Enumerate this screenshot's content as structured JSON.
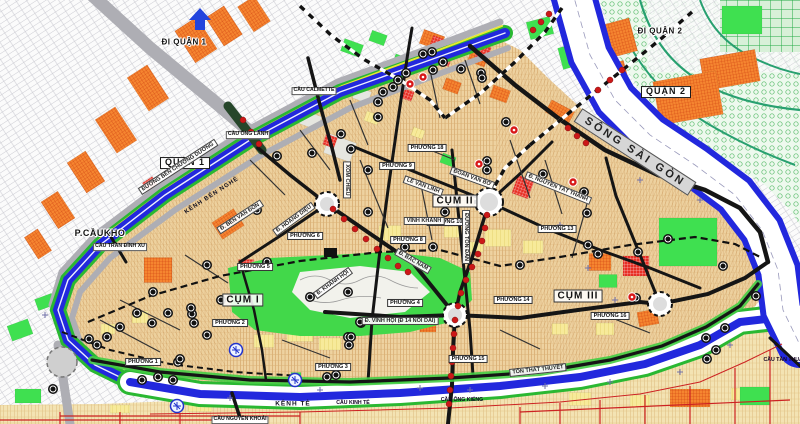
{
  "palette": {
    "river_blue": "#2228dd",
    "canal_green_bank": "#2ab832",
    "land_tan": "#eed2a0",
    "park_green": "#42d84a",
    "parcel_orange": "#f58530",
    "parcel_red": "#e82f25",
    "parcel_yellow": "#f7ea9a",
    "road_black": "#151515",
    "road_grey": "#aeaeb4",
    "d7_road_red": "#cc2222",
    "q2_road_teal": "#28a070",
    "station_dot_red": "#cc1818",
    "label_band_grey": "#d6d6d6"
  },
  "labels": {
    "regions": [
      {
        "id": "di-quan-1",
        "text": "ĐI QUẬN 1",
        "x": 184,
        "y": 43,
        "rot": 0,
        "style": "plain-bold halo",
        "size": 8
      },
      {
        "id": "di-quan-2",
        "text": "ĐI QUẬN 2",
        "x": 660,
        "y": 32,
        "rot": 0,
        "style": "plain-bold halo",
        "size": 8
      },
      {
        "id": "quan-1",
        "text": "QUẬN 1",
        "x": 185,
        "y": 163,
        "rot": 0,
        "style": "boxed-lg",
        "size": 9
      },
      {
        "id": "quan-2",
        "text": "QUẬN 2",
        "x": 666,
        "y": 92,
        "rot": 0,
        "style": "boxed-lg",
        "size": 9
      },
      {
        "id": "p-caukho",
        "text": "P.CẦUKHO",
        "x": 100,
        "y": 234,
        "rot": 0,
        "style": "plain-bold halo",
        "size": 9
      },
      {
        "id": "cum-1",
        "text": "CỤM I",
        "x": 243,
        "y": 300,
        "rot": 0,
        "style": "cum",
        "size": 10
      },
      {
        "id": "cum-2",
        "text": "CỤM II",
        "x": 455,
        "y": 201,
        "rot": 0,
        "style": "cum",
        "size": 10
      },
      {
        "id": "cum-3",
        "text": "CỤM III",
        "x": 578,
        "y": 296,
        "rot": 0,
        "style": "cum",
        "size": 10
      }
    ],
    "water": [
      {
        "id": "song-sai-gon",
        "text": "SÔNG SÀI GÒN",
        "x": 635,
        "y": 152,
        "rot": 33,
        "style": "river-band",
        "size": 11
      },
      {
        "id": "kenh-ben-nghe",
        "text": "KÊNH BẾN NGHÉ",
        "x": 212,
        "y": 196,
        "rot": -33,
        "style": "canal-lbl",
        "size": 6
      },
      {
        "id": "kenh-te",
        "text": "KÊNH TẺ",
        "x": 293,
        "y": 404,
        "rot": 0,
        "style": "canal-lbl",
        "size": 6.5
      }
    ],
    "wards": [
      {
        "text": "PHƯỜNG 1",
        "x": 143,
        "y": 362
      },
      {
        "text": "PHƯỜNG 2",
        "x": 230,
        "y": 323
      },
      {
        "text": "PHƯỜNG 3",
        "x": 333,
        "y": 367
      },
      {
        "text": "PHƯỜNG 4",
        "x": 405,
        "y": 303
      },
      {
        "text": "PHƯỜNG 5",
        "x": 255,
        "y": 267
      },
      {
        "text": "PHƯỜNG 6",
        "x": 305,
        "y": 236
      },
      {
        "text": "PHƯỜNG 8",
        "x": 408,
        "y": 240
      },
      {
        "text": "PHƯỜNG 9",
        "x": 397,
        "y": 166
      },
      {
        "text": "PHƯỜNG 10",
        "x": 446,
        "y": 222
      },
      {
        "text": "PHƯỜNG 13",
        "x": 557,
        "y": 229
      },
      {
        "text": "PHƯỜNG 14",
        "x": 513,
        "y": 300
      },
      {
        "text": "PHƯỜNG 15",
        "x": 468,
        "y": 359
      },
      {
        "text": "PHƯỜNG 16",
        "x": 610,
        "y": 316
      },
      {
        "text": "PHƯỜNG 18",
        "x": 427,
        "y": 148
      }
    ],
    "streets": [
      {
        "text": "ĐƯỜNG BẾN CHƯƠNG DƯƠNG",
        "x": 178,
        "y": 167,
        "rot": -33
      },
      {
        "text": "Đ. BẾN VÂN ĐỒN",
        "x": 240,
        "y": 217,
        "rot": -33
      },
      {
        "text": "Đ. NGUYỄN TẤT THÀNH",
        "x": 558,
        "y": 188,
        "rot": 22
      },
      {
        "text": "LÊ VĂN LINH",
        "x": 423,
        "y": 186,
        "rot": 20
      },
      {
        "text": "ĐOÀN VĂN BƠ",
        "x": 472,
        "y": 178,
        "rot": 20
      },
      {
        "text": "ĐƯỜNG TÔN ĐẢN",
        "x": 466,
        "y": 237,
        "rot": 90
      },
      {
        "text": "XÓM CHIẾU",
        "x": 347,
        "y": 180,
        "rot": 90
      },
      {
        "text": "Đ. HOÀNG DIỆU",
        "x": 294,
        "y": 219,
        "rot": -36
      },
      {
        "text": "Đ. BẮC NAM",
        "x": 413,
        "y": 261,
        "rot": 30
      },
      {
        "text": "Đ. VĨNH HỘI (Đ 14 NỐI DÀI)",
        "x": 400,
        "y": 321,
        "rot": 0
      },
      {
        "text": "VĨNH KHÁNH",
        "x": 424,
        "y": 221,
        "rot": 0
      },
      {
        "text": "Đ. KHÁNH HỘI",
        "x": 333,
        "y": 283,
        "rot": -36
      },
      {
        "text": "TÔN THẤT THUYẾT",
        "x": 538,
        "y": 370,
        "rot": -6
      }
    ],
    "bridges": [
      {
        "text": "CẦU ÔNG LÃNH",
        "x": 248,
        "y": 135,
        "boxed": true
      },
      {
        "text": "CẦU CALMETTE",
        "x": 314,
        "y": 91,
        "boxed": true
      },
      {
        "text": "CẦU TRẦN ĐÌNH XU",
        "x": 120,
        "y": 247,
        "boxed": true
      },
      {
        "text": "CẦU NGUYỄN KHOÁI",
        "x": 240,
        "y": 420,
        "boxed": true
      },
      {
        "text": "CẦU KINH TẺ",
        "x": 353,
        "y": 404,
        "boxed": false
      },
      {
        "text": "CẦU ÔNG KIỂNG",
        "x": 462,
        "y": 401,
        "boxed": false
      },
      {
        "text": "CẦU TÂN THUẬN",
        "x": 785,
        "y": 361,
        "boxed": false
      }
    ]
  }
}
